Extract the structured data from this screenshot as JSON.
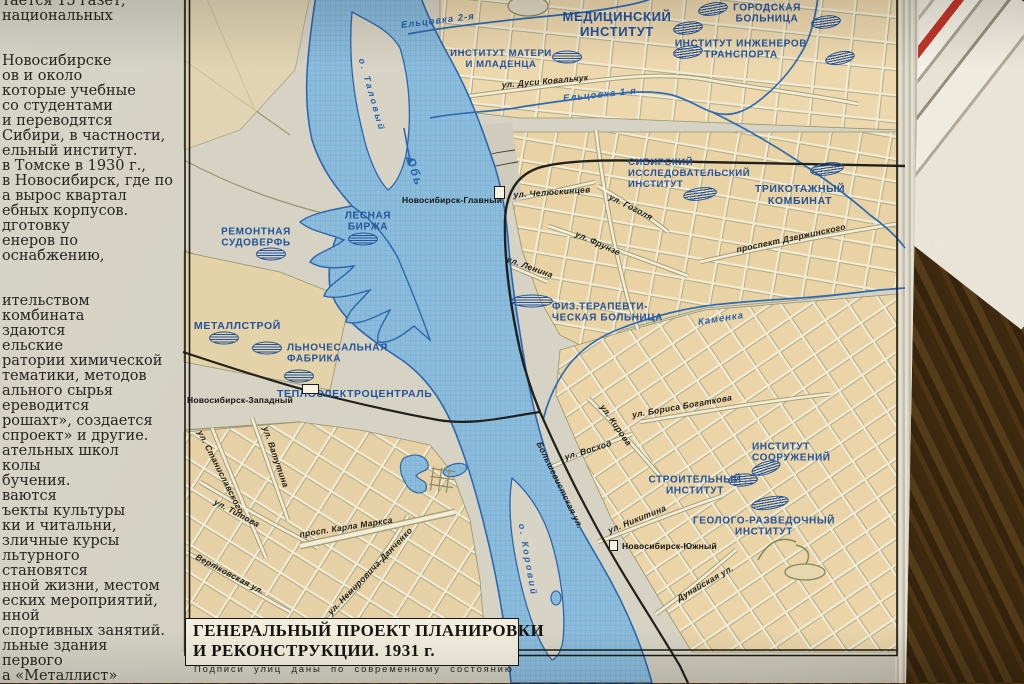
{
  "page": {
    "left_column_lines": [
      "тается 15 газет,",
      "национальных",
      "",
      "",
      "Новосибирске",
      "ов и около",
      "которые учебные",
      "со студентами",
      "и переводятся",
      "Сибири, в частности,",
      "ельный институт.",
      "в Томске в 1930 г.,",
      "в Новосибирск, где по",
      "а вырос квартал",
      "ебных корпусов.",
      "дготовку",
      "енеров по",
      "оснабжению,",
      "",
      "",
      "ительством",
      "комбината",
      "здаются",
      "ельские",
      "ратории химической",
      "тематики, методов",
      "ального сырья",
      "ереводится",
      "рошахт», создается",
      "спроект» и другие.",
      "ательных школ",
      "колы",
      "бучения.",
      "ваются",
      "ъекты культуры",
      "ки и читальни,",
      "зличные курсы",
      "льтурного",
      "становятся",
      "нной жизни, местом",
      "еских мероприятий,",
      "нной",
      "спортивных занятий.",
      "льные здания",
      "первого",
      "а «Металлист»"
    ],
    "caption": "Подписи улиц даны по современному состоянию"
  },
  "map": {
    "title_line1": "ГЕНЕРАЛЬНЫЙ ПРОЕКТ ПЛАНИРОВКИ",
    "title_line2": "И РЕКОНСТРУКЦИИ. 1931 г.",
    "colors": {
      "label_blue": "#24539b",
      "water_blue": "#2a62ad",
      "block_tan": "#e9d2a4",
      "page": "#d3d0c3",
      "water_fill": "#8cbcdc"
    },
    "institutions": [
      {
        "lines": [
          "МЕДИЦИНСКИЙ",
          "ИНСТИТУТ"
        ],
        "x": 617,
        "y": 25,
        "fs": 13
      },
      {
        "lines": [
          "ГОРОДСКАЯ",
          "БОЛЬНИЦА"
        ],
        "x": 767,
        "y": 14,
        "fs": 10
      },
      {
        "lines": [
          "ИНСТИТУТ ИНЖЕНЕРОВ",
          "ТРАНСПОРТА"
        ],
        "x": 741,
        "y": 50,
        "fs": 10
      },
      {
        "lines": [
          "ИНСТИТУТ МАТЕРИ",
          "И МЛАДЕНЦА"
        ],
        "x": 501,
        "y": 60,
        "fs": 9.5
      },
      {
        "lines": [
          "СИБИРСКИЙ",
          "ИССЛЕДОВАТЕЛЬСКИЙ",
          "ИНСТИТУТ"
        ],
        "x": 628,
        "y": 174,
        "fs": 9.5,
        "ax": 0,
        "ta": "left"
      },
      {
        "lines": [
          "ТРИКОТАЖНЫЙ",
          "КОМБИНАТ"
        ],
        "x": 800,
        "y": 196,
        "fs": 10.5
      },
      {
        "lines": [
          "РЕМОНТНАЯ",
          "СУДОВЕРФЬ"
        ],
        "x": 256,
        "y": 238,
        "fs": 10
      },
      {
        "lines": [
          "ЛЕСНАЯ",
          "БИРЖА"
        ],
        "x": 368,
        "y": 222,
        "fs": 10
      },
      {
        "lines": [
          "МЕТАЛЛСТРОЙ"
        ],
        "x": 194,
        "y": 327,
        "fs": 10.5,
        "ax": 0,
        "ta": "left"
      },
      {
        "lines": [
          "ЛЬНОЧЕСАЛЬНАЯ",
          "ФАБРИКА"
        ],
        "x": 287,
        "y": 354,
        "fs": 10,
        "ax": 0,
        "ta": "left"
      },
      {
        "lines": [
          "ТЕПЛОЭЛЕКТРОЦЕНТРАЛЬ"
        ],
        "x": 277,
        "y": 395,
        "fs": 10.5,
        "ax": 0,
        "ta": "left"
      },
      {
        "lines": [
          "ФИЗ.ТЕРАПЕВТИ-",
          "ЧЕСКАЯ БОЛЬНИЦА"
        ],
        "x": 552,
        "y": 313,
        "fs": 10,
        "ax": 0,
        "ta": "left"
      },
      {
        "lines": [
          "ИНСТИТУТ",
          "СООРУЖЕНИЙ"
        ],
        "x": 752,
        "y": 453,
        "fs": 10,
        "ax": 0,
        "ta": "left"
      },
      {
        "lines": [
          "СТРОИТЕЛЬНЫЙ",
          "ИНСТИТУТ"
        ],
        "x": 695,
        "y": 486,
        "fs": 10
      },
      {
        "lines": [
          "ГЕОЛОГО-РАЗВЕДОЧНЫЙ",
          "ИНСТИТУТ"
        ],
        "x": 764,
        "y": 527,
        "fs": 10
      }
    ],
    "industry_symbols": [
      {
        "x": 826,
        "y": 22,
        "r": -8
      },
      {
        "x": 840,
        "y": 58,
        "r": -12
      },
      {
        "x": 713,
        "y": 9,
        "r": -10
      },
      {
        "x": 688,
        "y": 28,
        "r": -8
      },
      {
        "x": 688,
        "y": 52,
        "r": -8
      },
      {
        "x": 567,
        "y": 57,
        "r": 0
      },
      {
        "x": 700,
        "y": 194,
        "r": -8,
        "w": 34
      },
      {
        "x": 827,
        "y": 169,
        "r": -8,
        "w": 34
      },
      {
        "x": 271,
        "y": 254,
        "r": 0
      },
      {
        "x": 363,
        "y": 239,
        "r": 0
      },
      {
        "x": 224,
        "y": 338,
        "r": 0
      },
      {
        "x": 267,
        "y": 348,
        "r": 0
      },
      {
        "x": 299,
        "y": 376,
        "r": 0
      },
      {
        "x": 532,
        "y": 301,
        "r": 0,
        "w": 42
      },
      {
        "x": 766,
        "y": 468,
        "r": -18
      },
      {
        "x": 743,
        "y": 480,
        "r": -5
      },
      {
        "x": 770,
        "y": 503,
        "r": -10,
        "w": 38
      }
    ],
    "streets": [
      {
        "t": "ул. Дуси Ковальчук",
        "x": 545,
        "y": 81,
        "r": -5
      },
      {
        "t": "ул. Челюскинцев",
        "x": 552,
        "y": 192,
        "r": -4
      },
      {
        "t": "ул. Гоголя",
        "x": 631,
        "y": 207,
        "r": 27
      },
      {
        "t": "ул. Фрунзе",
        "x": 598,
        "y": 243,
        "r": 24
      },
      {
        "t": "ул. Ленина",
        "x": 530,
        "y": 267,
        "r": 20
      },
      {
        "t": "проспект Дзержинского",
        "x": 791,
        "y": 238,
        "r": -12
      },
      {
        "t": "ул. Кирова",
        "x": 616,
        "y": 425,
        "r": 55
      },
      {
        "t": "ул. Бориса Богаткова",
        "x": 682,
        "y": 406,
        "r": -10
      },
      {
        "t": "ул. Восход",
        "x": 588,
        "y": 450,
        "r": -17
      },
      {
        "t": "Большевистская ул.",
        "x": 560,
        "y": 485,
        "r": 64
      },
      {
        "t": "ул. Никитина",
        "x": 637,
        "y": 519,
        "r": -22
      },
      {
        "t": "Дунайская ул.",
        "x": 705,
        "y": 583,
        "r": -30
      },
      {
        "t": "ул. Титова",
        "x": 237,
        "y": 513,
        "r": 28
      },
      {
        "t": "ул. Станиславского",
        "x": 221,
        "y": 472,
        "r": 63
      },
      {
        "t": "ул. Ватутина",
        "x": 276,
        "y": 457,
        "r": 71
      },
      {
        "t": "просп. Карла Маркса",
        "x": 346,
        "y": 527,
        "r": -9
      },
      {
        "t": "Вертковская ул.",
        "x": 230,
        "y": 574,
        "r": 28
      },
      {
        "t": "ул. Немировича-Данченко",
        "x": 370,
        "y": 571,
        "r": -46
      }
    ],
    "water_labels": [
      {
        "t": "Ельцовка 2-я",
        "x": 438,
        "y": 21,
        "r": -7
      },
      {
        "t": "Ельцовка 1-я",
        "x": 600,
        "y": 95,
        "r": -6
      },
      {
        "t": "Каменка",
        "x": 721,
        "y": 319,
        "r": -9
      },
      {
        "t": "Обь",
        "x": 415,
        "y": 172,
        "r": 72,
        "fs": 12,
        "ls": 2
      },
      {
        "t": "о. Таловый",
        "x": 372,
        "y": 95,
        "r": 74,
        "fs": 9,
        "ls": 2.5
      },
      {
        "t": "о. Коровий",
        "x": 528,
        "y": 560,
        "r": 80,
        "fs": 9,
        "ls": 2.5
      }
    ],
    "stations": [
      {
        "t": "Новосибирск-Главный",
        "x": 402,
        "y": 200,
        "ax": 0,
        "rect": [
          494,
          186,
          11,
          13
        ]
      },
      {
        "t": "Новосибирск-Западный",
        "x": 187,
        "y": 400,
        "ax": 0,
        "rect": [
          302,
          384,
          17,
          10
        ]
      },
      {
        "t": "Новосибирск-Южный",
        "x": 622,
        "y": 546,
        "ax": 0,
        "rect": [
          609,
          540,
          9,
          11
        ]
      }
    ]
  }
}
